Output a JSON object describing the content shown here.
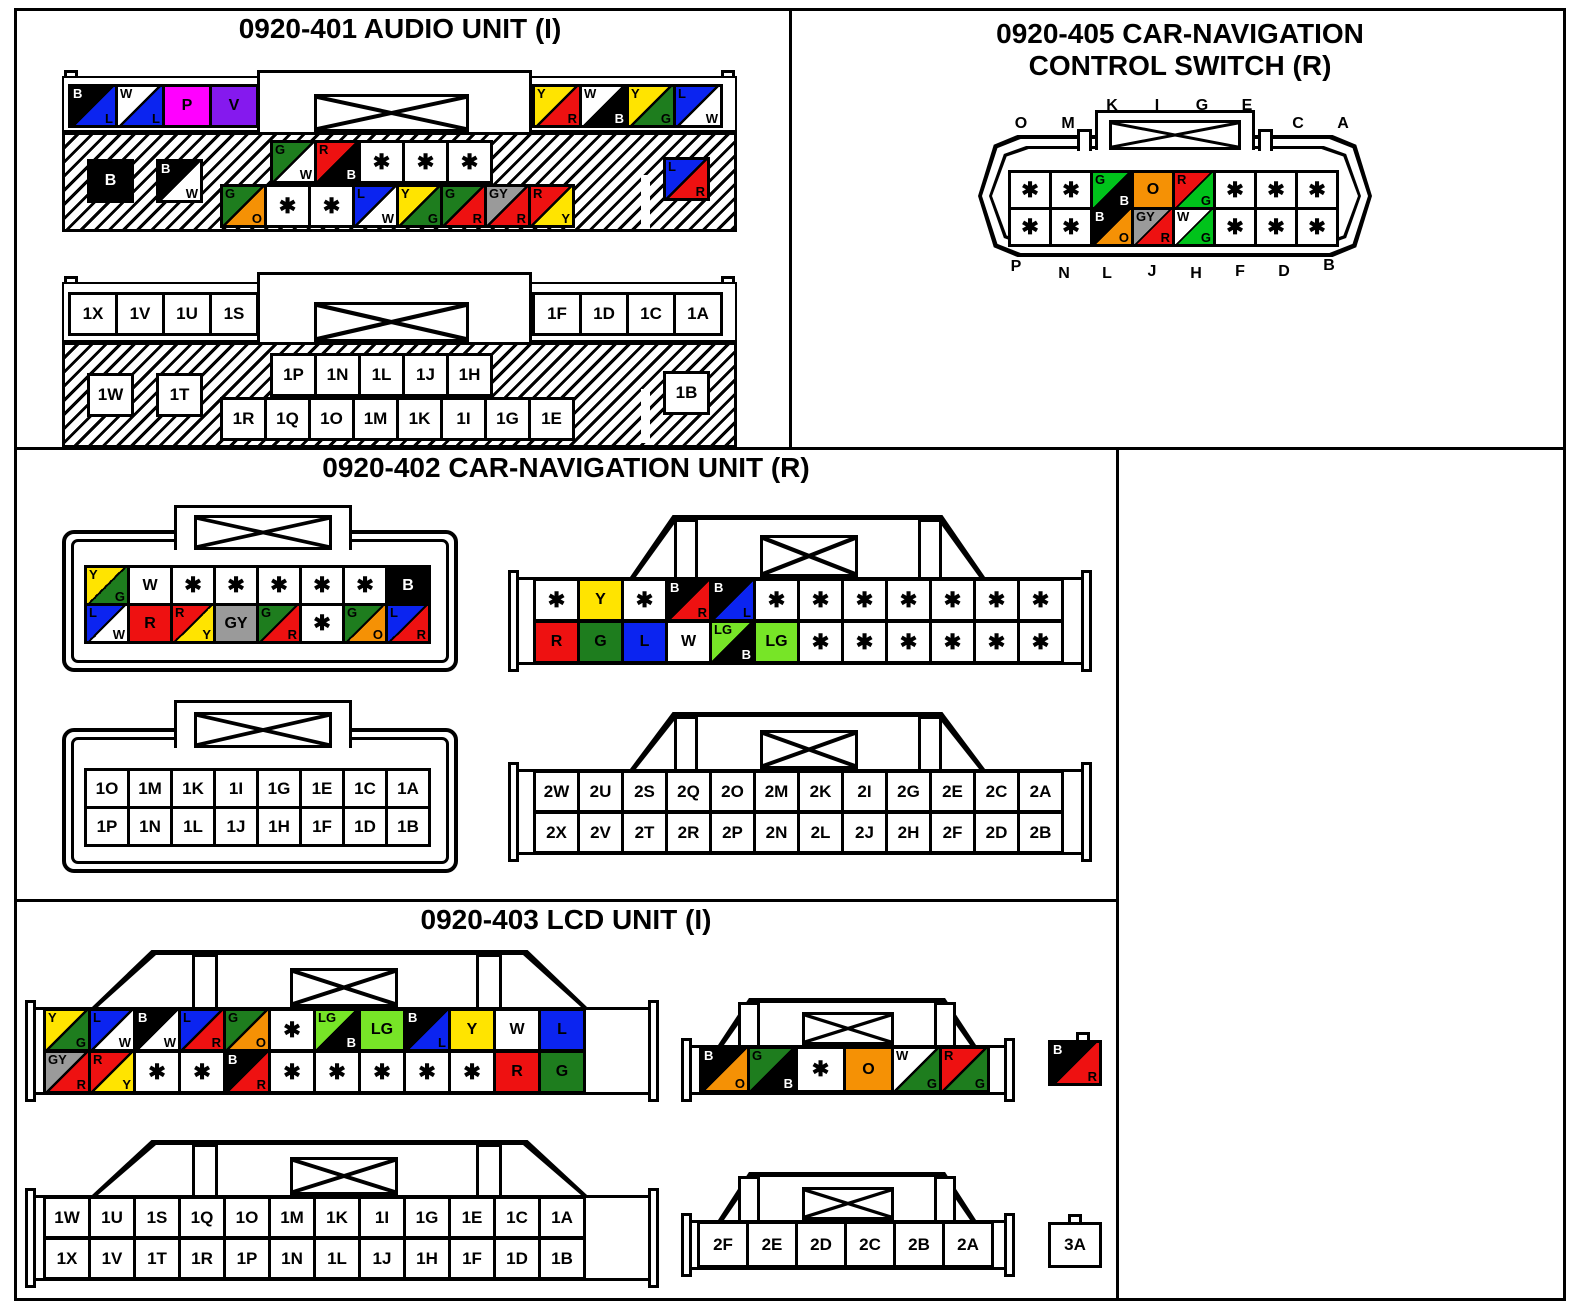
{
  "colors": {
    "B": "#000000",
    "W": "#ffffff",
    "L": "#0b24f0",
    "R": "#ee1111",
    "Y": "#ffe400",
    "G": "#1e7d1e",
    "G2": "#00c31b",
    "LG": "#77e527",
    "O": "#f59105",
    "GY": "#9a9a9a",
    "P": "#ff00ff",
    "V": "#8519ee"
  },
  "unused_symbol": "✱",
  "panels": {
    "audio": {
      "title": "0920-401 AUDIO UNIT (I)",
      "connector1": {
        "row1_left": [
          "B/L",
          "W/L",
          "P",
          "V"
        ],
        "row1_right": [
          "Y/R",
          "W/B",
          "Y/G",
          "L/W"
        ],
        "hatch_pair": [
          "B",
          "B/W"
        ],
        "hatch_upper": [
          "G/W",
          "R/B",
          "*",
          "*",
          "*"
        ],
        "hatch_lower": [
          "G/O",
          "*",
          "*",
          "L/W",
          "Y/G",
          "G/R",
          "GY/R",
          "R/Y"
        ],
        "hatch_right": [
          "L/R"
        ]
      },
      "connector2": {
        "row1_left": [
          "1X",
          "1V",
          "1U",
          "1S"
        ],
        "row1_right": [
          "1F",
          "1D",
          "1C",
          "1A"
        ],
        "hatch_pair": [
          "1W",
          "1T"
        ],
        "hatch_upper": [
          "1P",
          "1N",
          "1L",
          "1J",
          "1H"
        ],
        "hatch_lower": [
          "1R",
          "1Q",
          "1O",
          "1M",
          "1K",
          "1I",
          "1G",
          "1E"
        ],
        "hatch_right": [
          "1B"
        ]
      }
    },
    "control_switch": {
      "title_line1": "0920-405 CAR-NAVIGATION",
      "title_line2": "CONTROL SWITCH (R)",
      "letters_top": [
        "O",
        "M",
        "K",
        "I",
        "G",
        "E",
        "C",
        "A"
      ],
      "letters_bottom": [
        "P",
        "N",
        "L",
        "J",
        "H",
        "F",
        "D",
        "B"
      ],
      "row1": [
        "*",
        "*",
        "G2/B",
        "O",
        "R/G2",
        "*",
        "*",
        "*"
      ],
      "row2": [
        "*",
        "*",
        "B/O",
        "GY/R",
        "W/G2",
        "*",
        "*",
        "*"
      ]
    },
    "carnav": {
      "title": "0920-402 CAR-NAVIGATION UNIT (R)",
      "left_color": {
        "row1": [
          "Y/G",
          "W",
          "*",
          "*",
          "*",
          "*",
          "*",
          "B"
        ],
        "row2": [
          "L/W",
          "R",
          "R/Y",
          "GY",
          "G/R",
          "*",
          "G/O",
          "L/R"
        ]
      },
      "right_color": {
        "row1": [
          "*",
          "Y",
          "*",
          "B/R",
          "B/L",
          "*",
          "*",
          "*",
          "*",
          "*",
          "*",
          "*"
        ],
        "row2": [
          "R",
          "G",
          "L",
          "W",
          "LG/B",
          "LG",
          "*",
          "*",
          "*",
          "*",
          "*",
          "*"
        ]
      },
      "left_pins": {
        "row1": [
          "1O",
          "1M",
          "1K",
          "1I",
          "1G",
          "1E",
          "1C",
          "1A"
        ],
        "row2": [
          "1P",
          "1N",
          "1L",
          "1J",
          "1H",
          "1F",
          "1D",
          "1B"
        ]
      },
      "right_pins": {
        "row1": [
          "2W",
          "2U",
          "2S",
          "2Q",
          "2O",
          "2M",
          "2K",
          "2I",
          "2G",
          "2E",
          "2C",
          "2A"
        ],
        "row2": [
          "2X",
          "2V",
          "2T",
          "2R",
          "2P",
          "2N",
          "2L",
          "2J",
          "2H",
          "2F",
          "2D",
          "2B"
        ]
      }
    },
    "lcd": {
      "title": "0920-403 LCD UNIT (I)",
      "main_color": {
        "row1": [
          "Y/G",
          "L/W",
          "B/W",
          "L/R",
          "G/O",
          "*",
          "LG/B",
          "LG",
          "B/L",
          "Y",
          "W",
          "L"
        ],
        "row2": [
          "GY/R",
          "R/Y",
          "*",
          "*",
          "B/R",
          "*",
          "*",
          "*",
          "*",
          "*",
          "R",
          "G"
        ]
      },
      "small_color": {
        "row1": [
          "B/O",
          "G/B",
          "*",
          "O",
          "W/G",
          "R/G"
        ]
      },
      "tiny_color": {
        "row1": [
          "B/R"
        ]
      },
      "main_pins": {
        "row1": [
          "1W",
          "1U",
          "1S",
          "1Q",
          "1O",
          "1M",
          "1K",
          "1I",
          "1G",
          "1E",
          "1C",
          "1A"
        ],
        "row2": [
          "1X",
          "1V",
          "1T",
          "1R",
          "1P",
          "1N",
          "1L",
          "1J",
          "1H",
          "1F",
          "1D",
          "1B"
        ]
      },
      "small_pins": {
        "row1": [
          "2F",
          "2E",
          "2D",
          "2C",
          "2B",
          "2A"
        ]
      },
      "tiny_pin": {
        "row1": [
          "3A"
        ]
      }
    }
  }
}
